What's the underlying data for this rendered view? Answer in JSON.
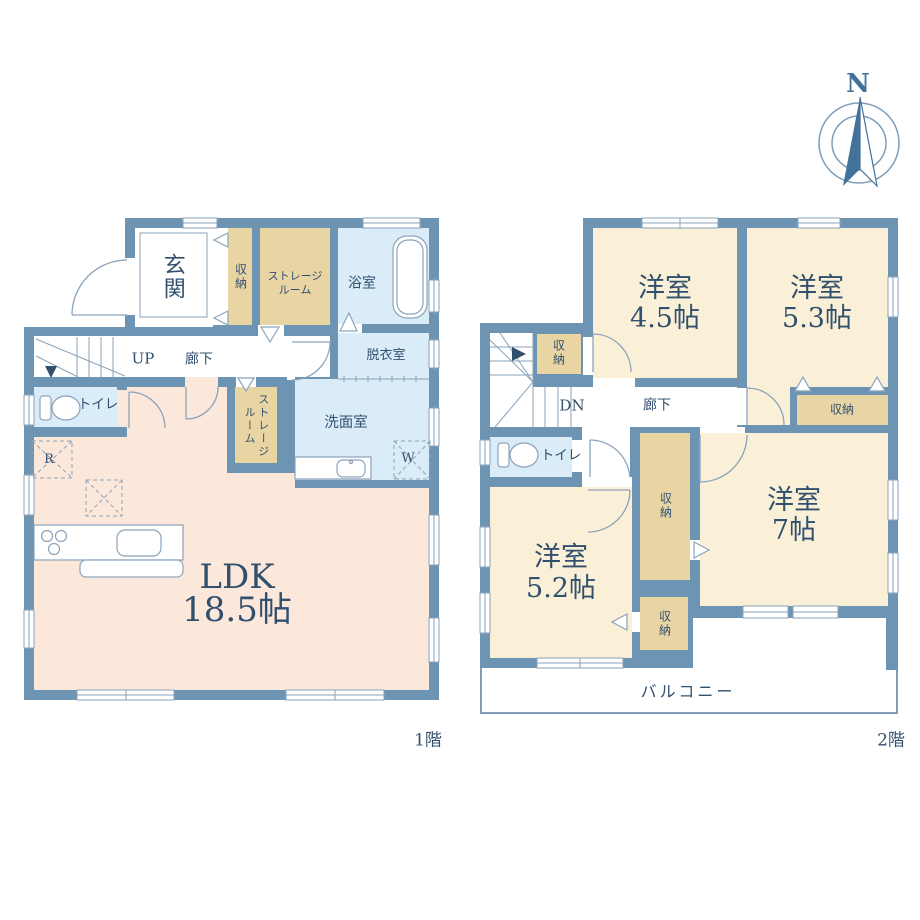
{
  "colors": {
    "wall": "#6e94b4",
    "cream": "#faf0d7",
    "tan": "#e9d5a4",
    "blue": "#d9ecf7",
    "peach": "#fce8db",
    "text": "#31506e",
    "line": "#8aa3bb",
    "accent": "#44719a"
  },
  "compass": {
    "north": "N"
  },
  "floor1": {
    "caption": "1階",
    "ldk": {
      "name": "LDK",
      "size": "18.5帖"
    },
    "genkan": "玄関",
    "closet": "収納",
    "storage_top": {
      "line1": "ストレージ",
      "line2": "ルーム"
    },
    "storage_mid": {
      "line1": "ストレージ",
      "line2": "ルーム"
    },
    "bath": "浴室",
    "dressing": "脱衣室",
    "washroom": "洗面室",
    "hall": "廊下",
    "up": "UP",
    "toilet": "トイレ",
    "washer": "W",
    "fridge": "R"
  },
  "floor2": {
    "caption": "2階",
    "rooms": [
      {
        "name": "洋室",
        "size": "4.5帖"
      },
      {
        "name": "洋室",
        "size": "5.3帖"
      },
      {
        "name": "洋室",
        "size": "7帖"
      },
      {
        "name": "洋室",
        "size": "5.2帖"
      }
    ],
    "closet": "収納",
    "dn": "DN",
    "hall": "廊下",
    "toilet": "トイレ",
    "balcony": "バルコニー"
  }
}
